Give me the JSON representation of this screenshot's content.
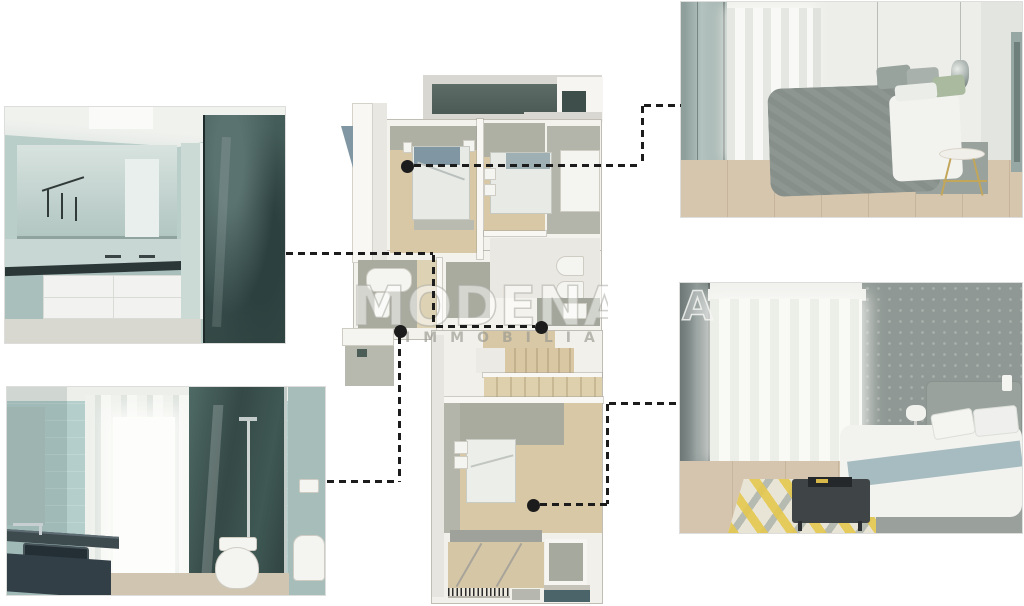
{
  "document": {
    "kind": "real-estate floor-plan flyer",
    "background": "#ffffff"
  },
  "watermark": {
    "brand": "MODENA",
    "sub": "IMMOBILIARE",
    "corner_letter": "A"
  },
  "palette": {
    "connector_ink": "#1c1c1c",
    "plan_floor_beige": "#d8c8a6",
    "plan_floor_beige_light": "#ddd2b4",
    "plan_tile_gray_green": "#a9ab9f",
    "plan_terrace_dark_teal": "#57665f",
    "plan_dark_square": "#3e4e4a",
    "plan_light_gray": "#d9d7d1",
    "plan_wall_white": "#f6f5f1",
    "accent_steel_blue": "#8097a3",
    "accent_sage_green": "#a9ba9e",
    "rug_yellow": "#e4c84e",
    "bath_tile_aqua": "#b3cecb",
    "shower_glass_teal": "#3f5854"
  },
  "photos": {
    "top_left": {
      "name": "bathroom-vanity-render"
    },
    "bottom_left": {
      "name": "bathroom-shower-render"
    },
    "top_right": {
      "name": "bedroom-gray-render"
    },
    "bottom_right": {
      "name": "bedroom-rug-render"
    }
  },
  "connectors": [
    {
      "name": "to-top-right-bedroom",
      "dot": {
        "x": 407,
        "y": 166
      },
      "segments": [
        {
          "o": "h",
          "x": 414,
          "y": 164,
          "len": 228
        },
        {
          "o": "v",
          "x": 641,
          "y": 106,
          "len": 60
        },
        {
          "o": "h",
          "x": 644,
          "y": 104,
          "len": 37
        }
      ]
    },
    {
      "name": "to-top-left-bathroom",
      "dot": {
        "x": 541,
        "y": 327
      },
      "segments": [
        {
          "o": "h",
          "x": 286,
          "y": 252,
          "len": 147
        },
        {
          "o": "v",
          "x": 432,
          "y": 255,
          "len": 71
        },
        {
          "o": "h",
          "x": 436,
          "y": 325,
          "len": 99
        }
      ]
    },
    {
      "name": "to-bottom-left-bathroom",
      "dot": {
        "x": 400,
        "y": 331
      },
      "segments": [
        {
          "o": "v",
          "x": 398,
          "y": 337,
          "len": 145
        },
        {
          "o": "h",
          "x": 327,
          "y": 480,
          "len": 72
        }
      ]
    },
    {
      "name": "to-bottom-right-bedroom",
      "dot": {
        "x": 533,
        "y": 505
      },
      "segments": [
        {
          "o": "h",
          "x": 540,
          "y": 503,
          "len": 68
        },
        {
          "o": "v",
          "x": 606,
          "y": 404,
          "len": 100
        },
        {
          "o": "h",
          "x": 609,
          "y": 402,
          "len": 71
        }
      ]
    }
  ]
}
